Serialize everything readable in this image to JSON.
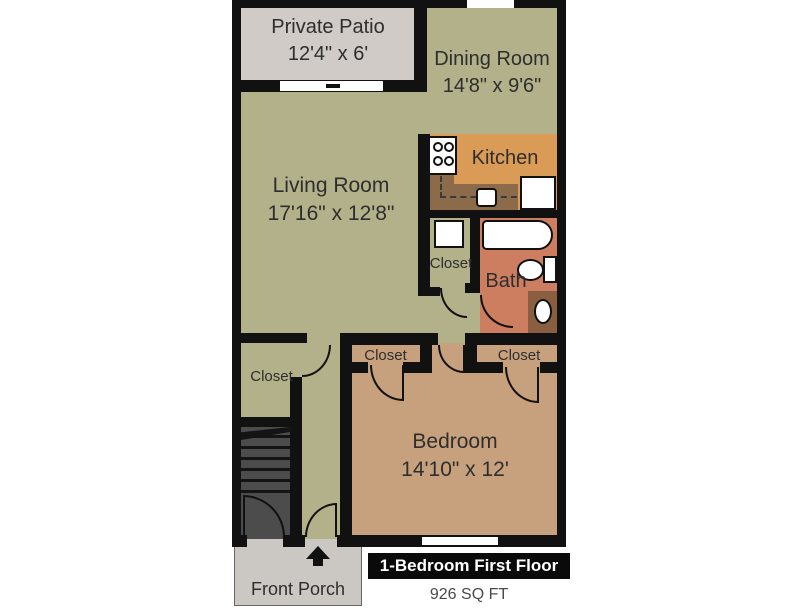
{
  "title_badge": "1-Bedroom First Floor",
  "sqft_label": "926 SQ FT",
  "rooms": {
    "private_patio": {
      "name": "Private Patio",
      "dims": "12'4\" x 6'"
    },
    "dining_room": {
      "name": "Dining Room",
      "dims": "14'8\" x 9'6\""
    },
    "living_room": {
      "name": "Living Room",
      "dims": "17'16\" x 12'8\""
    },
    "kitchen": {
      "name": "Kitchen"
    },
    "bath": {
      "name": "Bath"
    },
    "bedroom": {
      "name": "Bedroom",
      "dims": "14'10\" x 12'"
    },
    "front_porch": {
      "name": "Front Porch"
    },
    "closet_hall": {
      "name": "Closet"
    },
    "closet_living": {
      "name": "Closet"
    },
    "closet_bedroom_left": {
      "name": "Closet"
    },
    "closet_bedroom_right": {
      "name": "Closet"
    }
  },
  "colors": {
    "wall_color": "#111111",
    "green_floor": "#b3b18a",
    "patio_gray": "#d0cbc7",
    "porch_gray": "#cbc7c3",
    "kitchen_orange": "#d99b56",
    "counter_brown": "#8c6b4b",
    "bath_salmon": "#cd7e61",
    "vanity_brown": "#8a5e40",
    "bedroom_tan": "#c7a17d",
    "stairs_gray": "#4c4c4c",
    "text_dark": "#2e2e2e",
    "badge_bg": "#0a0a0a",
    "badge_text": "#ffffff",
    "sqft_text": "#4a4a4a"
  }
}
